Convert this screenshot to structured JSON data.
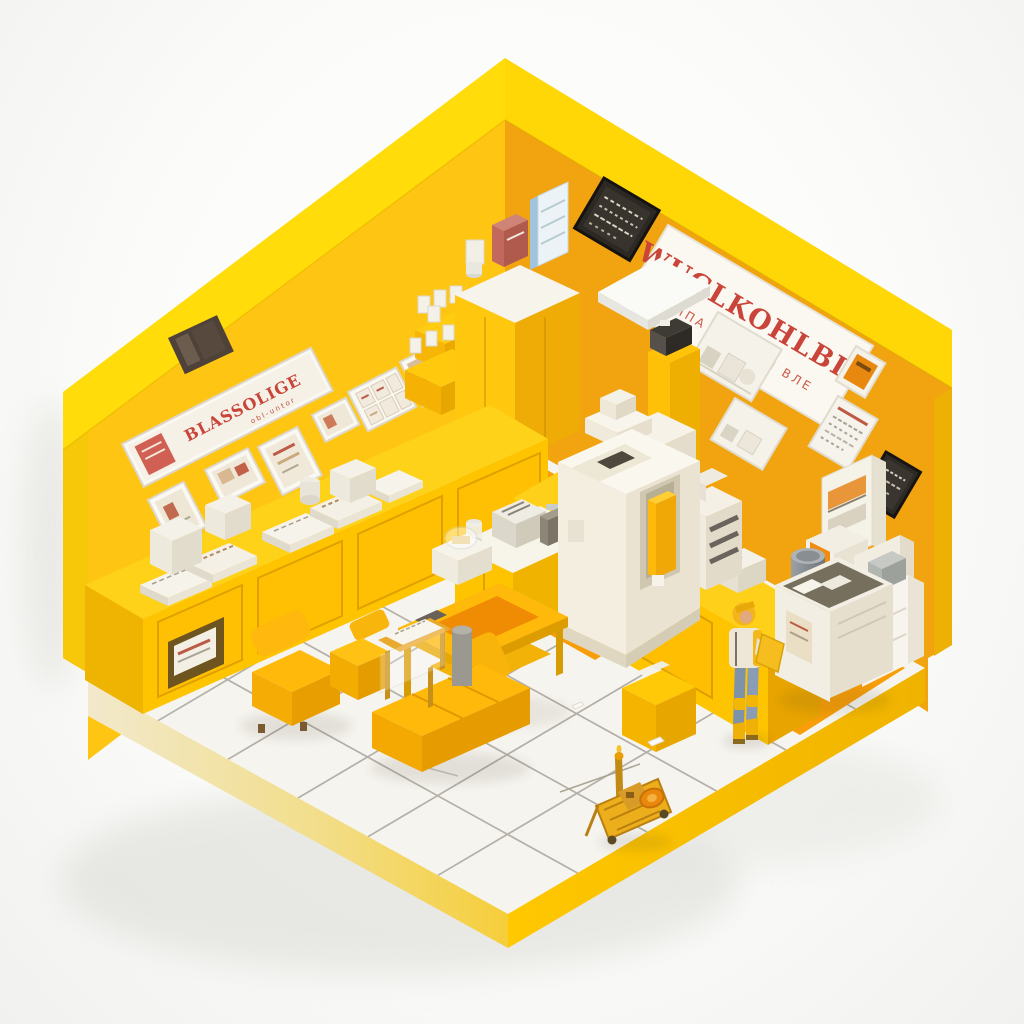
{
  "scene": {
    "subject": "Isometric miniature yellow kiosk shop interior with a worker figure"
  },
  "signs": {
    "banner_main": "WUGLKOHLBIC",
    "banner_sub": "ИПА ВПТ ИБЛ ВЛЕ",
    "left_sign_main": "BLASSOLIGE",
    "left_sign_sub": "obl-untor"
  },
  "palette": {
    "background": "#F7F7F5",
    "wall_outer": "#FFDC0A",
    "wall_left": "#FFC513",
    "wall_right": "#F1A40F",
    "counter_yellow": "#FFC400",
    "floor_tile": "#F6F4EE",
    "grout": "#A39F97",
    "orange_mat": "#F79E08",
    "machine_cream": "#F2EEE2",
    "sign_red": "#C9453A",
    "furniture_yellow": "#FFB90A",
    "jeans_blue": "#7E92AA"
  }
}
